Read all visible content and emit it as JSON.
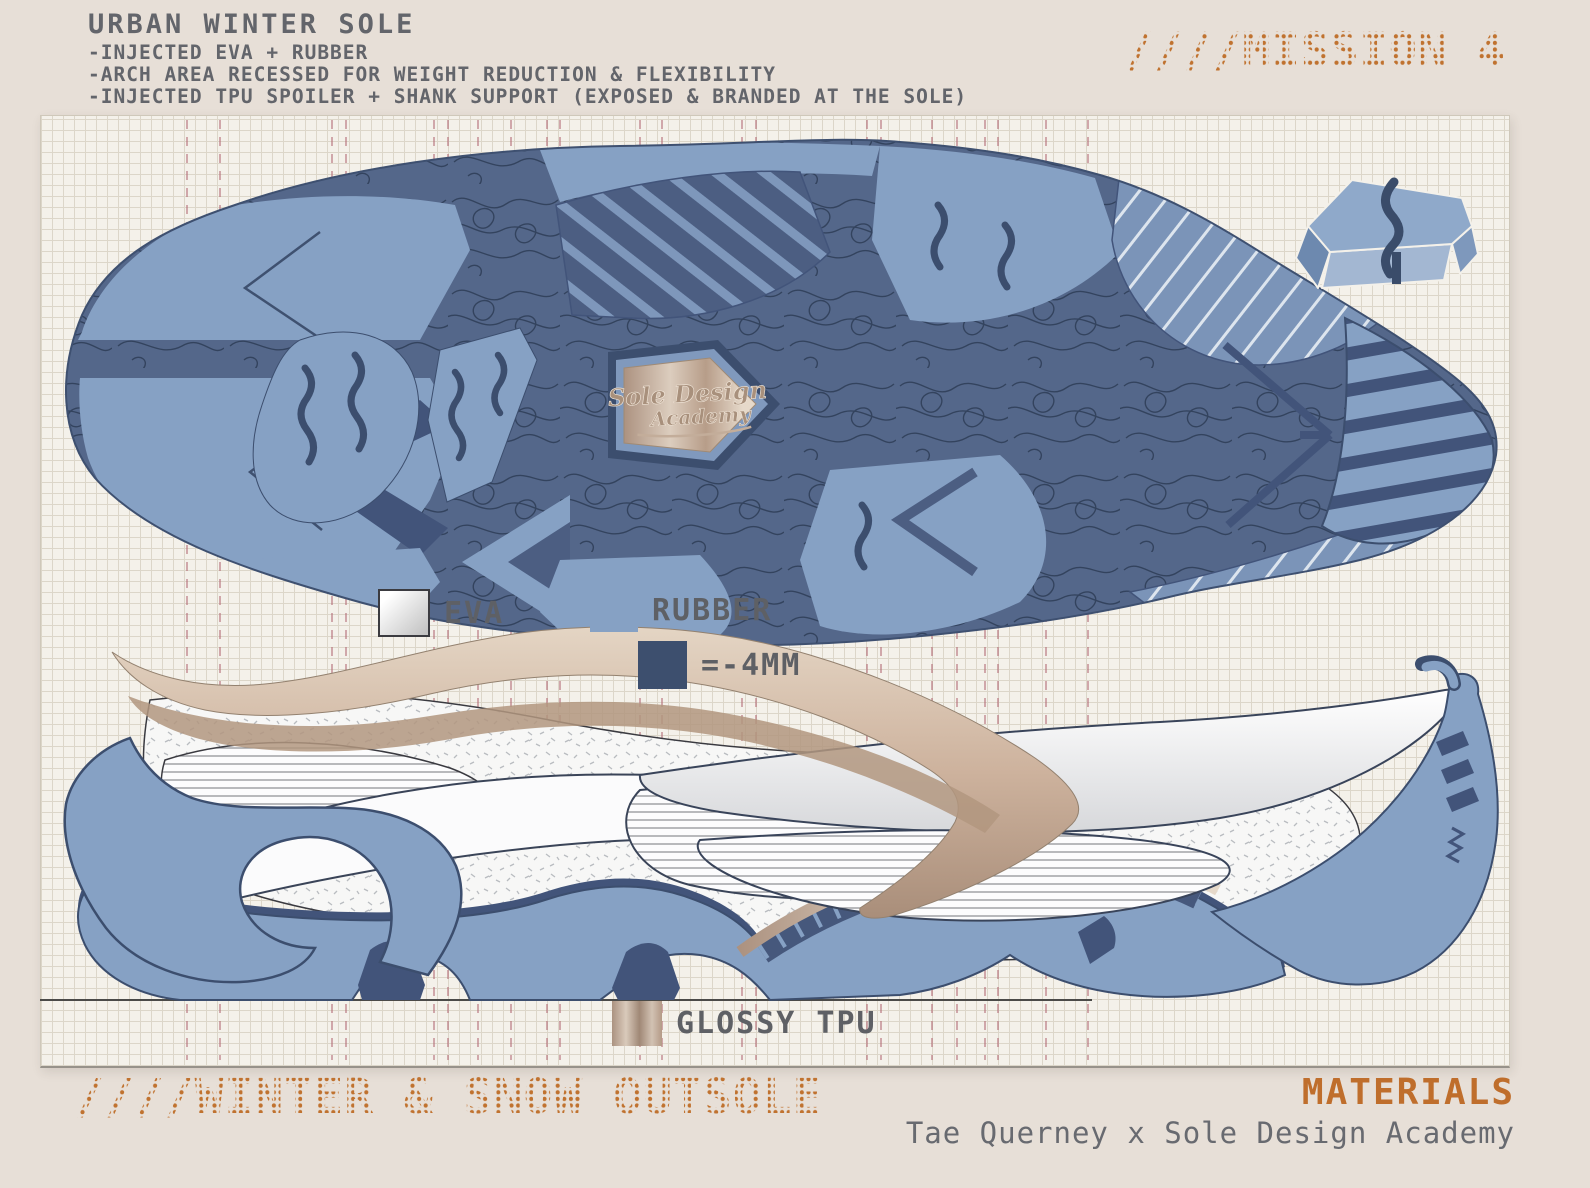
{
  "header": {
    "title": "URBAN WINTER SOLE",
    "bullets": [
      "-INJECTED EVA + RUBBER",
      "-ARCH AREA RECESSED FOR WEIGHT REDUCTION & FLEXIBILITY",
      "-INJECTED TPU SPOILER + SHANK SUPPORT (EXPOSED & BRANDED AT THE SOLE)"
    ],
    "mission_tag": "////MISSION 4"
  },
  "legend": {
    "items": [
      {
        "id": "eva",
        "label": "EVA",
        "swatch_color": "#ffffff-#c3c3c3"
      },
      {
        "id": "rubber",
        "label": "RUBBER",
        "swatch_color": "#86a1c4"
      },
      {
        "id": "depth",
        "label": "=-4MM",
        "swatch_color": "#3d4f6e"
      },
      {
        "id": "tpu",
        "label": "GLOSSY TPU",
        "swatch_color": "#c9b5a4"
      }
    ]
  },
  "badge": {
    "brand_line1": "Sole Design",
    "brand_line2": "Academy"
  },
  "footer": {
    "outsole_tag": "////WINTER & SNOW OUTSOLE",
    "materials_label": "MATERIALS",
    "byline": "Tae Querney x Sole Design Academy"
  },
  "colors": {
    "accent_orange": "#bf6e2c",
    "rubber_blue": "#86a1c4",
    "depth_navy": "#3d4f6e",
    "tread_recess": "#54678a",
    "text_grey": "#63656b",
    "paper": "#f4f1ea"
  }
}
